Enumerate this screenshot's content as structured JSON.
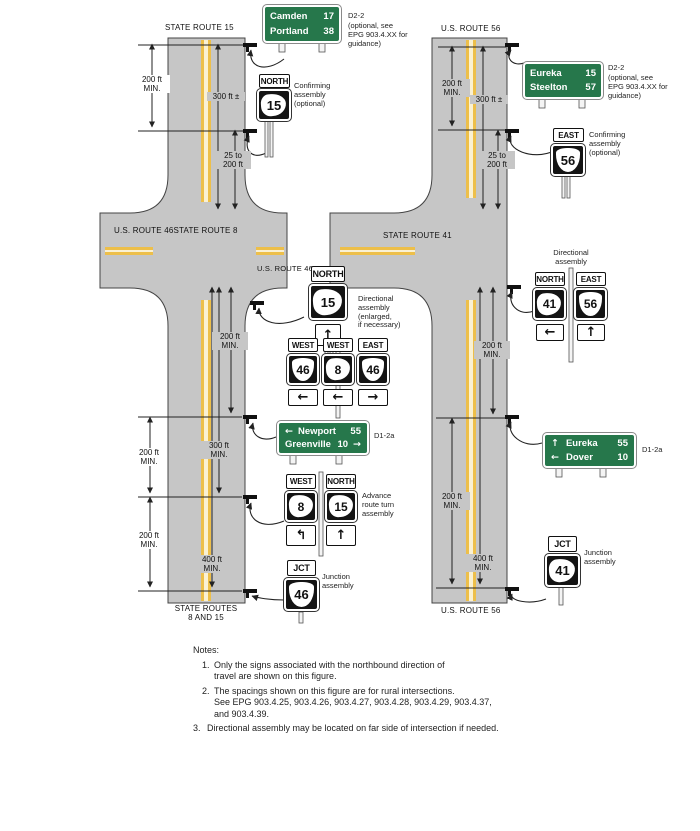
{
  "colors": {
    "sign_green": "#26774b",
    "road_gray": "#c6c6c6",
    "line_yellow": "#edbf4a",
    "line_pale": "#faf1d3"
  },
  "roads": {
    "sr15": "STATE ROUTE 15",
    "us56_top": "U.S. ROUTE 56",
    "us46_sr8": "U.S. ROUTE 46STATE ROUTE 8",
    "us46": "U.S. ROUTE 46",
    "sr41": "STATE ROUTE 41",
    "sr815_l1": "STATE ROUTES",
    "sr815_l2": "8 AND 15",
    "us56_bottom": "U.S. ROUTE 56"
  },
  "dims": {
    "ft200": "200 ft",
    "min": "MIN.",
    "ft300pm": "300 ft ±",
    "to25": "25 to",
    "ft300": "300 ft",
    "ft400": "400 ft"
  },
  "labels": {
    "d22": "D2-2",
    "d22_note": [
      "(optional, see",
      "EPG 903.4.XX for",
      "guidance)"
    ],
    "confirming": [
      "Confirming",
      "assembly",
      "(optional)"
    ],
    "directional_enlarged": [
      "Directional",
      "assembly",
      "(enlarged,",
      "if necessary)"
    ],
    "directional": [
      "Directional",
      "assembly"
    ],
    "d12a": "D1-2a",
    "advance": [
      "Advance",
      "route turn",
      "assembly"
    ],
    "junction": [
      "Junction",
      "assembly"
    ]
  },
  "guide_signs": {
    "camden": {
      "rows": [
        {
          "name": "Camden",
          "dist": "17"
        },
        {
          "name": "Portland",
          "dist": "38"
        }
      ]
    },
    "eureka_steelton": {
      "rows": [
        {
          "name": "Eureka",
          "dist": "15"
        },
        {
          "name": "Steelton",
          "dist": "57"
        }
      ]
    },
    "newport": {
      "row1": {
        "arrow": "←",
        "name": "Newport",
        "dist": "55"
      },
      "row2": {
        "name": "Greenville",
        "dist": "10",
        "arrow": "→"
      }
    },
    "eureka_dover": {
      "row1": {
        "arrow": "↑",
        "name": "Eureka",
        "dist": "55"
      },
      "row2": {
        "arrow": "←",
        "name": "Dover",
        "dist": "10"
      }
    }
  },
  "assemblies": {
    "left_confirming": {
      "banner": "NORTH",
      "route": "15"
    },
    "right_confirming": {
      "banner": "EAST",
      "route": "56"
    },
    "left_directional": {
      "banner": "NORTH",
      "route": "15",
      "arrow": "↑"
    },
    "trio": [
      {
        "banner": "WEST",
        "route": "46",
        "arrow": "←"
      },
      {
        "banner": "WEST",
        "route": "8",
        "arrow": "←"
      },
      {
        "banner": "EAST",
        "route": "46",
        "arrow": "→"
      }
    ],
    "advance": [
      {
        "banner": "WEST",
        "route": "8",
        "arrow": "↰"
      },
      {
        "banner": "NORTH",
        "route": "15",
        "arrow": "↑"
      }
    ],
    "right_directional": [
      {
        "banner": "NORTH",
        "route": "41",
        "arrow": "←"
      },
      {
        "banner": "EAST",
        "route": "56",
        "arrow": "↑"
      }
    ],
    "left_junction": {
      "banner": "JCT",
      "route": "46"
    },
    "right_junction": {
      "banner": "JCT",
      "route": "41"
    }
  },
  "notes": {
    "title": "Notes:",
    "n1": {
      "num": "1.",
      "l1": "Only the signs associated with the northbound direction of",
      "l2": "travel are shown on this figure."
    },
    "n2": {
      "num": "2.",
      "l1": "The spacings shown on this figure are for rural intersections.",
      "l2": "See EPG 903.4.25, 903.4.26, 903.4.27, 903.4.28, 903.4.29,  903.4.37,",
      "l3": "and 903.4.39."
    },
    "n3": {
      "num": "3.",
      "text": "Directional assembly may be located on far side of intersection if needed."
    }
  }
}
